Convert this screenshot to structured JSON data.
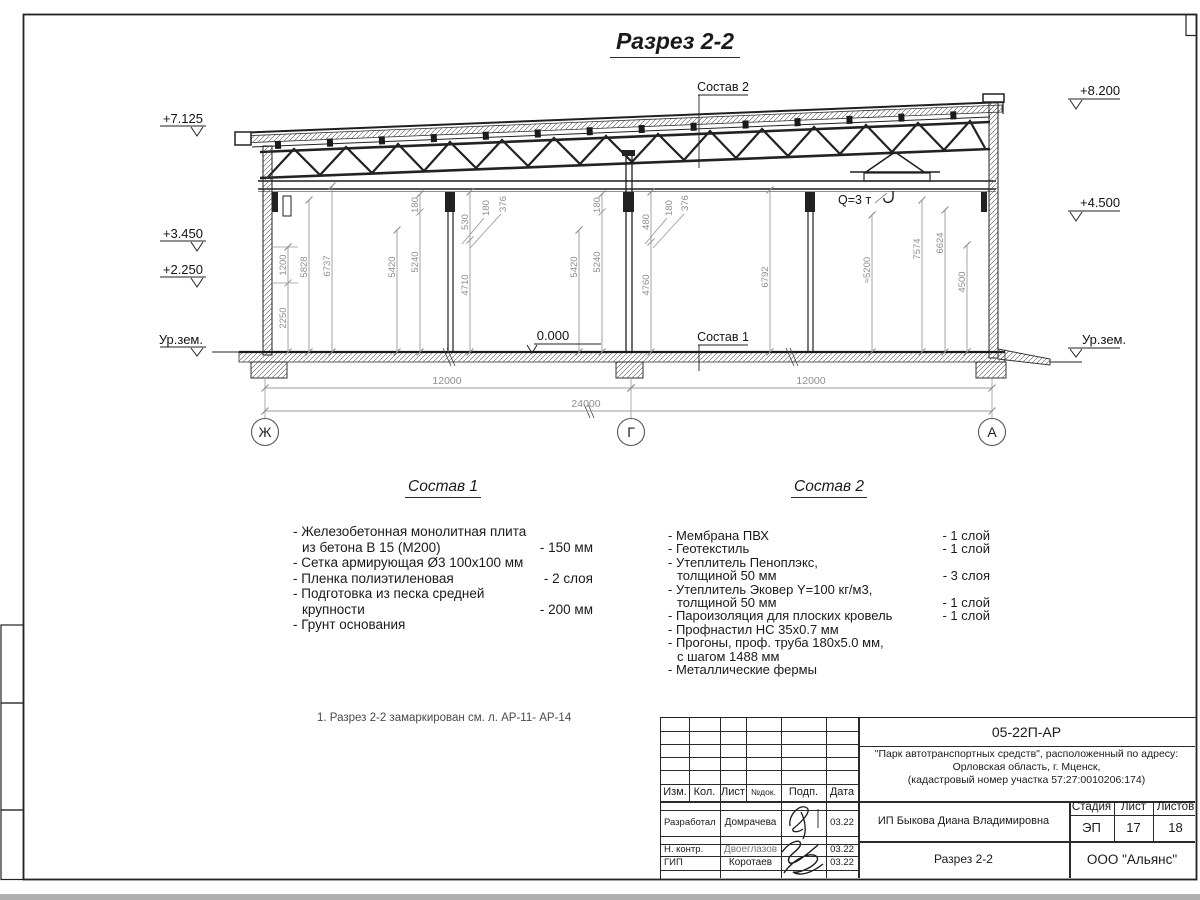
{
  "sheet": {
    "title": "Разрез 2-2",
    "note": "1. Разрез 2-2 замаркирован см. л. АР-11- АР-14"
  },
  "drawing": {
    "elev_left": [
      "+7.125",
      "+3.450",
      "+2.250",
      "Ур.зем."
    ],
    "elev_right": [
      "+8.200",
      "+4.500",
      "Ур.зем."
    ],
    "zero_mark": "0.000",
    "ref_top": "Состав 2",
    "ref_floor": "Состав 1",
    "crane": "Q=3 т",
    "axes": [
      "Ж",
      "Г",
      "А"
    ],
    "dims_v": [
      "1200",
      "2250",
      "5828",
      "6737",
      "5420",
      "180",
      "5240",
      "530",
      "4710",
      "180",
      "376",
      "5420",
      "180",
      "5240",
      "480",
      "4760",
      "180",
      "376",
      "6792",
      "≈5200",
      "7574",
      "6624",
      "4500"
    ],
    "dims_h": [
      "12000",
      "12000",
      "24000"
    ]
  },
  "sostav1": {
    "title": "Состав 1",
    "lines": [
      {
        "t": "- Железобетонная  монолитная плита",
        "v": ""
      },
      {
        "t": "из бетона В 15 (М200)",
        "v": "- 150 мм"
      },
      {
        "t": "- Сетка армирующая Ø3 100х100 мм",
        "v": ""
      },
      {
        "t": "- Пленка полиэтиленовая",
        "v": "-  2 слоя"
      },
      {
        "t": "- Подготовка из песка средней",
        "v": ""
      },
      {
        "t": "крупности",
        "v": "- 200 мм"
      },
      {
        "t": "- Грунт основания",
        "v": ""
      }
    ]
  },
  "sostav2": {
    "title": "Состав 2",
    "lines": [
      {
        "t": "- Мембрана ПВХ",
        "v": "- 1 слой"
      },
      {
        "t": "- Геотекстиль",
        "v": "- 1 слой"
      },
      {
        "t": "- Утеплитель Пеноплэкс,",
        "v": ""
      },
      {
        "t": "толщиной 50 мм",
        "v": "- 3 слоя"
      },
      {
        "t": "- Утеплитель Эковер Y=100 кг/м3,",
        "v": ""
      },
      {
        "t": "толщиной 50 мм",
        "v": "- 1 слой"
      },
      {
        "t": "- Пароизоляция для плоских кровель",
        "v": "- 1 слой"
      },
      {
        "t": "- Профнастил НС 35х0.7 мм",
        "v": ""
      },
      {
        "t": "- Прогоны, проф. труба 180х5.0 мм,",
        "v": ""
      },
      {
        "t": "с шагом 1488 мм",
        "v": ""
      },
      {
        "t": "- Металлические фермы",
        "v": ""
      }
    ]
  },
  "titleblock": {
    "code": "05-22П-АР",
    "project": [
      "\"Парк автотранспортных средств\",  расположенный по адресу:",
      "Орловская область, г. Мценск,",
      "(кадастровый номер участка 57:27:0010206:174)"
    ],
    "cols": [
      "Изм.",
      "Кол.",
      "Лист",
      "№док.",
      "Подп.",
      "Дата"
    ],
    "rows": [
      {
        "role": "Разработал",
        "name": "Домрачева",
        "date": "03.22"
      },
      {
        "role": "Н. контр.",
        "name": "Двоеглазов",
        "date": "03.22"
      },
      {
        "role": "ГИП",
        "name": "Коротаев",
        "date": "03.22"
      }
    ],
    "client": "ИП Быкова Диана Владимировна",
    "stage_headers": [
      "Стадия",
      "Лист",
      "Листов"
    ],
    "stage_values": [
      "ЭП",
      "17",
      "18"
    ],
    "doc_title": "Разрез 2-2",
    "org": "ООО \"Альянс\""
  }
}
